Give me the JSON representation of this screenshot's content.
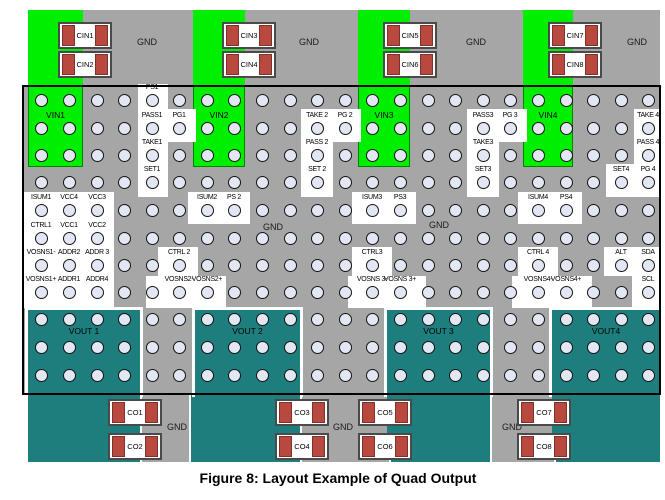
{
  "title": "Figure 8: Layout Example of Quad Output",
  "colors": {
    "ground_plane_gray": "#a6a6a6",
    "input_plane_green": "#00ef00",
    "output_plane_teal": "#1e7e7e",
    "via_fill": "#e3e7f4",
    "pad_red": "#b9493f",
    "patch_white": "#ffffff",
    "border_black": "#000000"
  },
  "regions": {
    "top_gray": [
      28,
      10,
      632,
      75
    ],
    "inner_gray": [
      22,
      85,
      639,
      310
    ],
    "bottom_teal": [
      28,
      395,
      632,
      67
    ],
    "bottom_gray_strips": [
      [
        140,
        395,
        47,
        67
      ],
      [
        300,
        395,
        87,
        67
      ],
      [
        490,
        395,
        62,
        67
      ]
    ],
    "border": [
      22,
      85,
      639,
      310
    ]
  },
  "vin_regions": [
    {
      "label": "VIN1",
      "rect": [
        28,
        10,
        55,
        157
      ]
    },
    {
      "label": "VIN2",
      "rect": [
        193,
        10,
        52,
        157
      ]
    },
    {
      "label": "VIN3",
      "rect": [
        358,
        10,
        52,
        157
      ]
    },
    {
      "label": "VIN4",
      "rect": [
        523,
        10,
        50,
        157
      ]
    }
  ],
  "vout_regions": [
    {
      "label": "VOUT 1",
      "rect": [
        28,
        310,
        112,
        150
      ]
    },
    {
      "label": "VOUT 2",
      "rect": [
        195,
        310,
        105,
        150
      ]
    },
    {
      "label": "VOUT 3",
      "rect": [
        387,
        310,
        103,
        150
      ]
    },
    {
      "label": "VOUT4",
      "rect": [
        552,
        310,
        108,
        150
      ]
    }
  ],
  "grid": {
    "columns": [
      41,
      69,
      97,
      124,
      152,
      179,
      207,
      234,
      262,
      290,
      317,
      345,
      372,
      400,
      428,
      455,
      483,
      510,
      538,
      566,
      593,
      621,
      648
    ],
    "rows": [
      100,
      128,
      155,
      182,
      210,
      238,
      265,
      292,
      319,
      347,
      375
    ]
  },
  "patches": [
    [
      138,
      84,
      30,
      113
    ],
    [
      166,
      109,
      30,
      33
    ],
    [
      301,
      109,
      32,
      88
    ],
    [
      333,
      109,
      28,
      33
    ],
    [
      467,
      109,
      32,
      88
    ],
    [
      499,
      109,
      28,
      33
    ],
    [
      634,
      109,
      28,
      88
    ],
    [
      606,
      164,
      30,
      33
    ],
    [
      24,
      192,
      90,
      116
    ],
    [
      188,
      192,
      62,
      32
    ],
    [
      352,
      192,
      64,
      32
    ],
    [
      518,
      192,
      64,
      32
    ],
    [
      158,
      247,
      40,
      29
    ],
    [
      146,
      276,
      80,
      32
    ],
    [
      352,
      247,
      40,
      29
    ],
    [
      348,
      276,
      78,
      32
    ],
    [
      518,
      247,
      40,
      29
    ],
    [
      512,
      276,
      80,
      32
    ],
    [
      604,
      247,
      58,
      29
    ],
    [
      632,
      276,
      30,
      32
    ]
  ],
  "pins": [
    {
      "t": "PS1",
      "x": 152,
      "y": 100
    },
    {
      "t": "PASS1",
      "x": 152,
      "y": 128
    },
    {
      "t": "PG1",
      "x": 179,
      "y": 128
    },
    {
      "t": "TAKE 2",
      "x": 317,
      "y": 128
    },
    {
      "t": "PG 2",
      "x": 345,
      "y": 128
    },
    {
      "t": "PASS3",
      "x": 483,
      "y": 128
    },
    {
      "t": "PG 3",
      "x": 510,
      "y": 128
    },
    {
      "t": "TAKE 4",
      "x": 648,
      "y": 128
    },
    {
      "t": "TAKE1",
      "x": 152,
      "y": 155
    },
    {
      "t": "PASS 2",
      "x": 317,
      "y": 155
    },
    {
      "t": "TAKE3",
      "x": 483,
      "y": 155
    },
    {
      "t": "PASS 4",
      "x": 648,
      "y": 155
    },
    {
      "t": "SET1",
      "x": 152,
      "y": 182
    },
    {
      "t": "SET 2",
      "x": 317,
      "y": 182
    },
    {
      "t": "SET3",
      "x": 483,
      "y": 182
    },
    {
      "t": "SET4",
      "x": 621,
      "y": 182
    },
    {
      "t": "PG 4",
      "x": 648,
      "y": 182
    },
    {
      "t": "ISUM1",
      "x": 41,
      "y": 210
    },
    {
      "t": "VCC4",
      "x": 69,
      "y": 210
    },
    {
      "t": "VCC3",
      "x": 97,
      "y": 210
    },
    {
      "t": "ISUM2",
      "x": 207,
      "y": 210
    },
    {
      "t": "PS 2",
      "x": 234,
      "y": 210
    },
    {
      "t": "ISUM3",
      "x": 372,
      "y": 210
    },
    {
      "t": "PS3",
      "x": 400,
      "y": 210
    },
    {
      "t": "ISUM4",
      "x": 538,
      "y": 210
    },
    {
      "t": "PS4",
      "x": 566,
      "y": 210
    },
    {
      "t": "CTRL1",
      "x": 41,
      "y": 238
    },
    {
      "t": "VCC1",
      "x": 69,
      "y": 238
    },
    {
      "t": "VCC2",
      "x": 97,
      "y": 238
    },
    {
      "t": "VOSNS1-",
      "x": 41,
      "y": 265
    },
    {
      "t": "ADDR2",
      "x": 69,
      "y": 265
    },
    {
      "t": "ADDR 3",
      "x": 97,
      "y": 265
    },
    {
      "t": "CTRL 2",
      "x": 179,
      "y": 265
    },
    {
      "t": "CTRL3",
      "x": 372,
      "y": 265
    },
    {
      "t": "CTRL 4",
      "x": 538,
      "y": 265
    },
    {
      "t": "ALT",
      "x": 621,
      "y": 265
    },
    {
      "t": "SDA",
      "x": 648,
      "y": 265
    },
    {
      "t": "VOSNS1+",
      "x": 41,
      "y": 292
    },
    {
      "t": "ADDR1",
      "x": 69,
      "y": 292
    },
    {
      "t": "ADDR4",
      "x": 97,
      "y": 292
    },
    {
      "t": "VOSNS2-",
      "x": 179,
      "y": 292
    },
    {
      "t": "VOSNS2+",
      "x": 207,
      "y": 292
    },
    {
      "t": "VOSNS 3-",
      "x": 372,
      "y": 292
    },
    {
      "t": "VOSNS 3+",
      "x": 400,
      "y": 292
    },
    {
      "t": "VOSNS4-",
      "x": 538,
      "y": 292
    },
    {
      "t": "VOSNS4+",
      "x": 566,
      "y": 292
    },
    {
      "t": "SCL",
      "x": 648,
      "y": 292
    }
  ],
  "gnd_labels": [
    {
      "text": "GND",
      "x": 147,
      "y": 37
    },
    {
      "text": "GND",
      "x": 309,
      "y": 37
    },
    {
      "text": "GND",
      "x": 476,
      "y": 37
    },
    {
      "text": "GND",
      "x": 637,
      "y": 37
    },
    {
      "text": "GND",
      "x": 273,
      "y": 222
    },
    {
      "text": "GND",
      "x": 439,
      "y": 220
    },
    {
      "text": "GND",
      "x": 177,
      "y": 422
    },
    {
      "text": "GND",
      "x": 343,
      "y": 422
    },
    {
      "text": "GND",
      "x": 512,
      "y": 422
    }
  ],
  "capacitors": {
    "box_w": 54,
    "box_h": 27,
    "cin": [
      {
        "label": "CIN1",
        "x": 58,
        "y": 22
      },
      {
        "label": "CIN2",
        "x": 58,
        "y": 51
      },
      {
        "label": "CIN3",
        "x": 222,
        "y": 22
      },
      {
        "label": "CIN4",
        "x": 222,
        "y": 51
      },
      {
        "label": "CIN5",
        "x": 383,
        "y": 22
      },
      {
        "label": "CIN6",
        "x": 383,
        "y": 51
      },
      {
        "label": "CIN7",
        "x": 548,
        "y": 22
      },
      {
        "label": "CIN8",
        "x": 548,
        "y": 51
      }
    ],
    "co": [
      {
        "label": "CO1",
        "x": 108,
        "y": 399
      },
      {
        "label": "CO2",
        "x": 108,
        "y": 433
      },
      {
        "label": "CO3",
        "x": 275,
        "y": 399
      },
      {
        "label": "CO4",
        "x": 275,
        "y": 433
      },
      {
        "label": "CO5",
        "x": 358,
        "y": 399
      },
      {
        "label": "CO6",
        "x": 358,
        "y": 433
      },
      {
        "label": "CO7",
        "x": 517,
        "y": 399
      },
      {
        "label": "CO8",
        "x": 517,
        "y": 433
      }
    ]
  }
}
